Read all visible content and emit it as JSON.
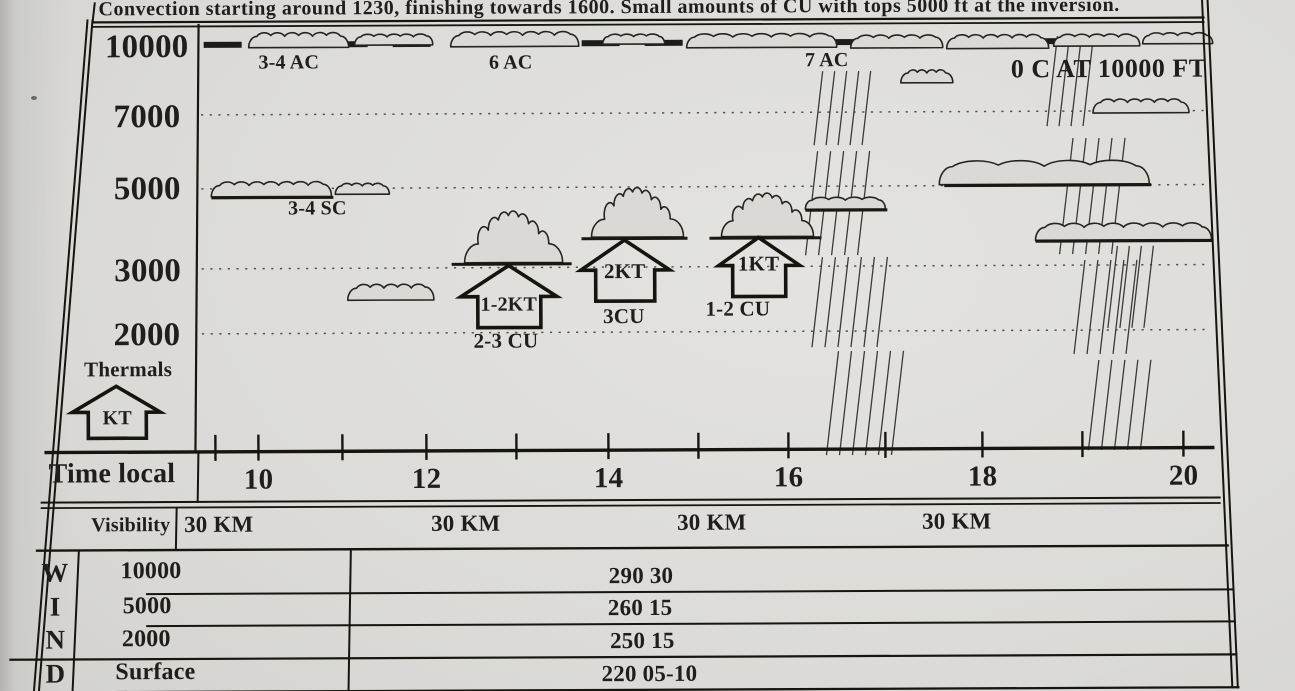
{
  "banner": {
    "text": "Convection starting around 1230, finishing towards 1600. Small amounts of CU with tops 5000 ft at the inversion."
  },
  "altitude_axis": {
    "labels": [
      "10000",
      "7000",
      "5000",
      "3000",
      "2000"
    ]
  },
  "thermals_legend": {
    "title": "Thermals",
    "unit": "KT"
  },
  "annotations": {
    "ac_left": "3-4 AC",
    "ac_mid": "6 AC",
    "ac_right": "7 AC",
    "freezing_level": "0 C AT 10000 FT",
    "sc": "3-4 SC",
    "thermal_left": "1-2KT",
    "thermal_mid": "2KT",
    "thermal_right": "1KT",
    "cu_left": "2-3 CU",
    "cu_mid": "3CU",
    "cu_right": "1-2 CU"
  },
  "time_axis": {
    "label": "Time local",
    "hours": [
      "10",
      "12",
      "14",
      "16",
      "18",
      "20"
    ]
  },
  "visibility_row": {
    "label": "Visibility",
    "values": [
      "30 KM",
      "30 KM",
      "30 KM",
      "30 KM"
    ]
  },
  "wind_section": {
    "letters": [
      "W",
      "I",
      "N",
      "D"
    ],
    "rows": [
      {
        "level": "10000",
        "value": "290 30"
      },
      {
        "level": "5000",
        "value": "260 15"
      },
      {
        "level": "2000",
        "value": "250 15"
      },
      {
        "level": "Surface",
        "value": "220 05-10"
      }
    ]
  },
  "chart_data": {
    "type": "table",
    "title": "Convection starting around 1230, finishing towards 1600. Small amounts of CU with tops 5000 ft at the inversion.",
    "xlabel": "Time local",
    "ylabel": "Altitude (ft)",
    "x_ticks": [
      10,
      12,
      14,
      16,
      18,
      20
    ],
    "y_ticks": [
      2000,
      3000,
      5000,
      7000,
      10000
    ],
    "xlim": [
      9,
      20.5
    ],
    "ylim": [
      0,
      10800
    ],
    "grid": "dotted horizontal lines at 2000/3000/5000/7000, heavy dashed inversion line at 10000",
    "cloud_layers": [
      {
        "label": "3-4 AC",
        "altitude_ft": 10000,
        "time_local": 10.5
      },
      {
        "label": "6 AC",
        "altitude_ft": 10000,
        "time_local": 13
      },
      {
        "label": "7 AC",
        "altitude_ft": 10000,
        "time_local": 16.5
      },
      {
        "label": "3-4 SC",
        "altitude_ft": 5000,
        "time_local": 10.5
      },
      {
        "label": "2-3 CU",
        "cloud_base_ft": 3000,
        "cloud_top_ft": 4300,
        "time_local": 12.8
      },
      {
        "label": "3CU",
        "cloud_base_ft": 3400,
        "cloud_top_ft": 4600,
        "time_local": 14.3
      },
      {
        "label": "1-2 CU",
        "cloud_base_ft": 3400,
        "cloud_top_ft": 4500,
        "time_local": 15.7
      }
    ],
    "thermals": [
      {
        "strength": "1-2KT",
        "time_local": 12.8
      },
      {
        "strength": "2KT",
        "time_local": 14.3
      },
      {
        "strength": "1KT",
        "time_local": 15.7
      }
    ],
    "freezing_level_note": "0 C AT 10000 FT",
    "virga_shower_streak_times_local": [
      16.7,
      19.2
    ],
    "visibility": [
      {
        "time_local": 10,
        "value": "30 KM"
      },
      {
        "time_local": 12.5,
        "value": "30 KM"
      },
      {
        "time_local": 15,
        "value": "30 KM"
      },
      {
        "time_local": 17.5,
        "value": "30 KM"
      }
    ],
    "wind": [
      {
        "level": "10000",
        "value": "290 30"
      },
      {
        "level": "5000",
        "value": "260 15"
      },
      {
        "level": "2000",
        "value": "250 15"
      },
      {
        "level": "Surface",
        "value": "220 05-10"
      }
    ]
  }
}
